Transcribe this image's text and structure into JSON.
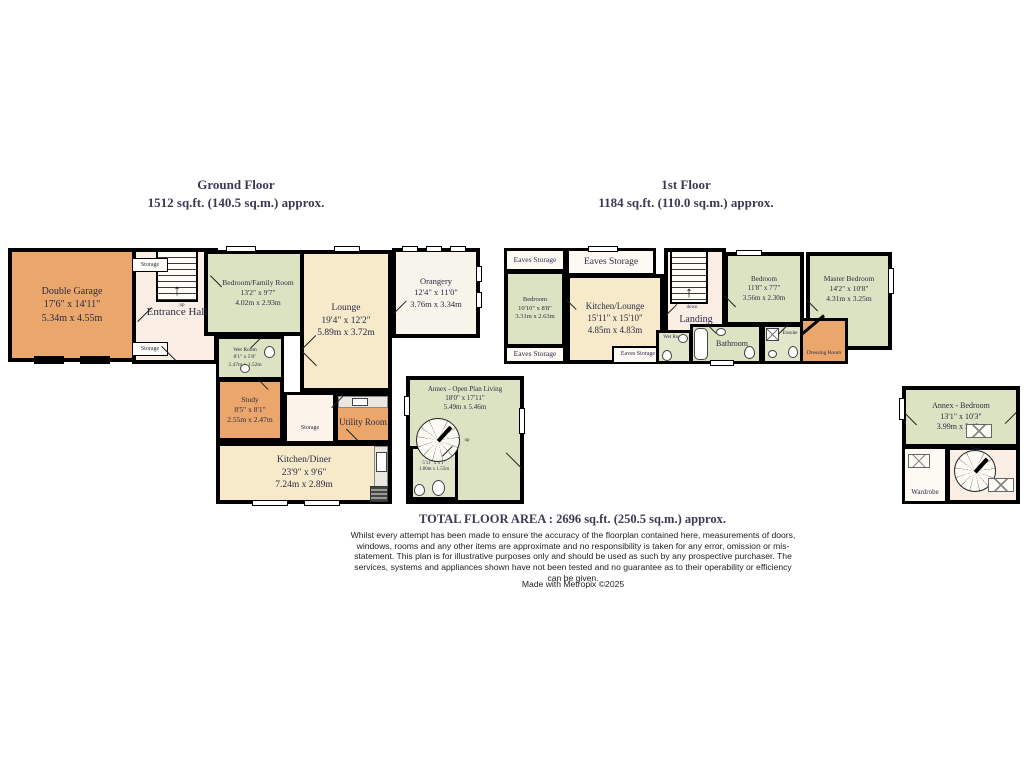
{
  "titles": {
    "ground": {
      "line1": "Ground Floor",
      "line2": "1512 sq.ft. (140.5 sq.m.) approx."
    },
    "first": {
      "line1": "1st Floor",
      "line2": "1184 sq.ft. (110.0 sq.m.) approx."
    }
  },
  "labels": {
    "eaves_storage": "Eaves Storage",
    "storage": "Storage",
    "entrance_hall": "Entrance Hall",
    "landing": "Landing",
    "utility": "Utility Room",
    "bathroom": "Bathroom",
    "ensuite": "Ensuite",
    "dressing": "Dressing Room",
    "wardrobe": "Wardrobe",
    "wet_room": "Wet Room",
    "up": "up",
    "down": "down"
  },
  "icons": {
    "up_arrow": "↑"
  },
  "rooms": {
    "double_garage": {
      "name": "Double Garage",
      "ft": "17'6\"  x 14'11\"",
      "m": "5.34m  x 4.55m"
    },
    "bedroom_family": {
      "name": "Bedroom/Family Room",
      "ft": "13'2\"  x 9'7\"",
      "m": "4.02m  x 2.93m"
    },
    "lounge": {
      "name": "Lounge",
      "ft": "19'4\"  x 12'2\"",
      "m": "5.89m  x 3.72m"
    },
    "orangery": {
      "name": "Orangery",
      "ft": "12'4\"  x 11'0\"",
      "m": "3.76m  x 3.34m"
    },
    "wet_room_ground": {
      "name": "Wet Room",
      "ft": "8'1\"  x 5'0\"",
      "m": "2.47m  x 1.52m"
    },
    "study": {
      "name": "Study",
      "ft": "8'5\"  x 8'1\"",
      "m": "2.55m  x 2.47m"
    },
    "kitchen_diner": {
      "name": "Kitchen/Diner",
      "ft": "23'9\"  x 9'6\"",
      "m": "7.24m  x 2.89m"
    },
    "annex_living": {
      "name": "Annex - Open Plan Living",
      "ft": "18'0\"  x 17'11\"",
      "m": "5.49m  x 5.46m"
    },
    "annex_wet": {
      "name": "Wet Room",
      "ft": "5'11\"  x 5'1\"",
      "m": "1.80m  x 1.55m"
    },
    "bedroom_first": {
      "name": "Bedroom",
      "ft": "10'10\"  x 8'8\"",
      "m": "3.31m  x 2.63m"
    },
    "kitchen_lounge": {
      "name": "Kitchen/Lounge",
      "ft": "15'11\"  x 15'10\"",
      "m": "4.85m  x 4.83m"
    },
    "bedroom_mid": {
      "name": "Bedroom",
      "ft": "11'8\"  x 7'7\"",
      "m": "3.56m  x 2.30m"
    },
    "master_bedroom": {
      "name": "Master Bedroom",
      "ft": "14'2\"  x 10'8\"",
      "m": "4.31m  x 3.25m"
    },
    "annex_bedroom": {
      "name": "Annex - Bedroom",
      "ft": "13'1\"  x 10'3\"",
      "m": "3.99m  x 3.12m"
    }
  },
  "footer": {
    "total": "TOTAL FLOOR AREA : 2696 sq.ft. (250.5 sq.m.) approx.",
    "disclaimer": "Whilst every attempt has been made to ensure the accuracy of the floorplan contained here, measurements of doors, windows, rooms and any other items are approximate and no responsibility is taken for any error, omission or mis-statement. This plan is for illustrative purposes only and should be used as such by any prospective purchaser. The services, systems and appliances shown have not been tested and no guarantee as to their operability or efficiency can be given.",
    "credit": "Made with Metropix ©2025"
  },
  "colors": {
    "wall": "#000000",
    "orange_room": "#EBA66C",
    "green_room": "#DCE3C2",
    "cream_room": "#F7EACA",
    "pink_hall": "#FBEFE5",
    "white_room": "#FDFAF4",
    "title_text": "#3B3A55",
    "plan_text": "#2B2B45"
  }
}
